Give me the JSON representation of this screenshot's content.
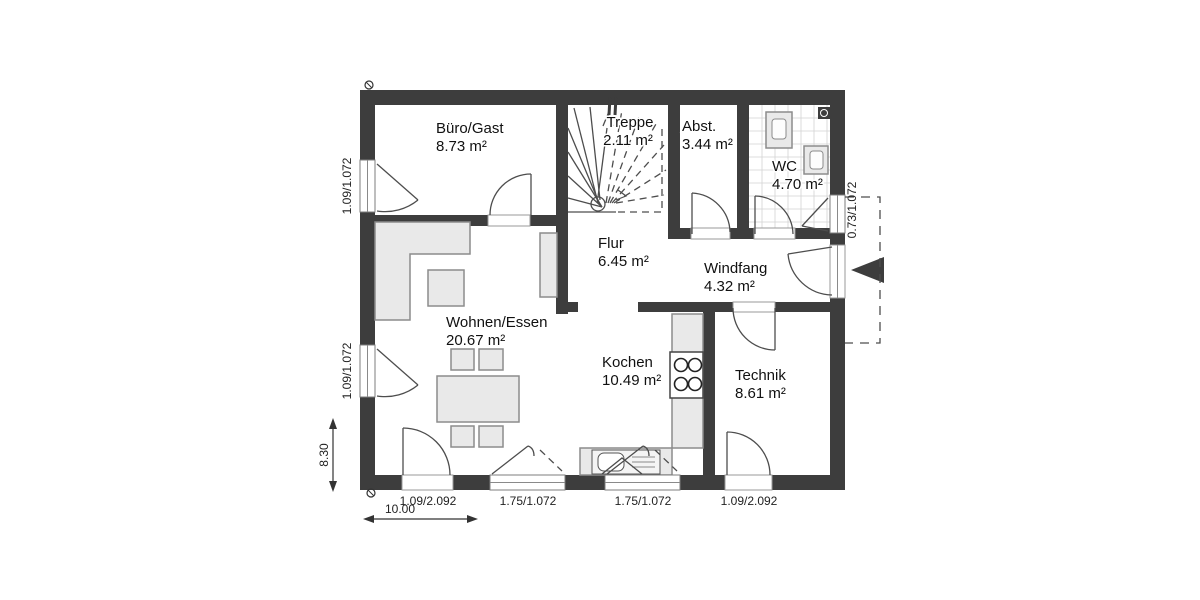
{
  "plan": {
    "rooms": [
      {
        "id": "buero",
        "name": "Büro/Gast",
        "area": "8.73 m²"
      },
      {
        "id": "treppe",
        "name": "Treppe",
        "area": "2.11 m²"
      },
      {
        "id": "abstellraum",
        "name": "Abst.",
        "area": "3.44 m²"
      },
      {
        "id": "wc",
        "name": "WC",
        "area": "4.70 m²"
      },
      {
        "id": "flur",
        "name": "Flur",
        "area": "6.45 m²"
      },
      {
        "id": "windfang",
        "name": "Windfang",
        "area": "4.32 m²"
      },
      {
        "id": "wohnen_essen",
        "name": "Wohnen/Essen",
        "area": "20.67 m²"
      },
      {
        "id": "kochen",
        "name": "Kochen",
        "area": "10.49 m²"
      },
      {
        "id": "technik",
        "name": "Technik",
        "area": "8.61 m²"
      }
    ],
    "opening_labels": {
      "left_window_top": "1.09/1.072",
      "left_window_bottom": "1.09/1.072",
      "right_window_wc": "0.73/1.072",
      "bottom_door_left": "1.09/2.092",
      "bottom_window_left": "1.75/1.072",
      "bottom_window_kitchen": "1.75/1.072",
      "bottom_door_technik": "1.09/2.092"
    },
    "dimensions": {
      "overall_width": "10.00",
      "overall_height": "8.30"
    },
    "colors": {
      "wall": "#3d3d3d",
      "furniture_fill": "#e9e9e9",
      "furniture_stroke": "#8c8c8c",
      "line_dark": "#4d4d4d",
      "text": "#111111"
    }
  }
}
